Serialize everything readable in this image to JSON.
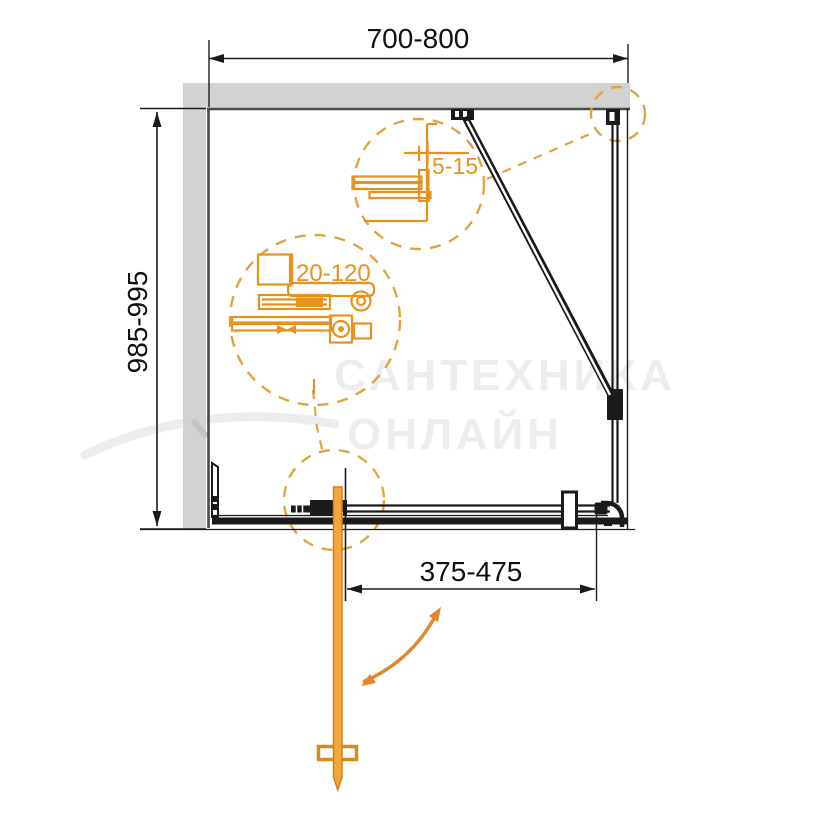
{
  "drawing": {
    "dimension_labels": {
      "top_width": "700-800",
      "side_depth": "985-995",
      "profile_gap": "5-15",
      "adjustment": "20-120",
      "door_width": "375-475"
    },
    "watermark": {
      "line1": "САНТЕХНИКА",
      "line2": "ОНЛАЙН"
    },
    "colors": {
      "accent_orange": "#e7921f",
      "dashed_orange": "#e2a43f",
      "handle_orange": "#f2a73b",
      "line_black": "#1b1b1b",
      "wall_fill": "#d2d2d2",
      "wall_edge": "#4a4a4a",
      "watermark_gray": "#ededed"
    }
  }
}
